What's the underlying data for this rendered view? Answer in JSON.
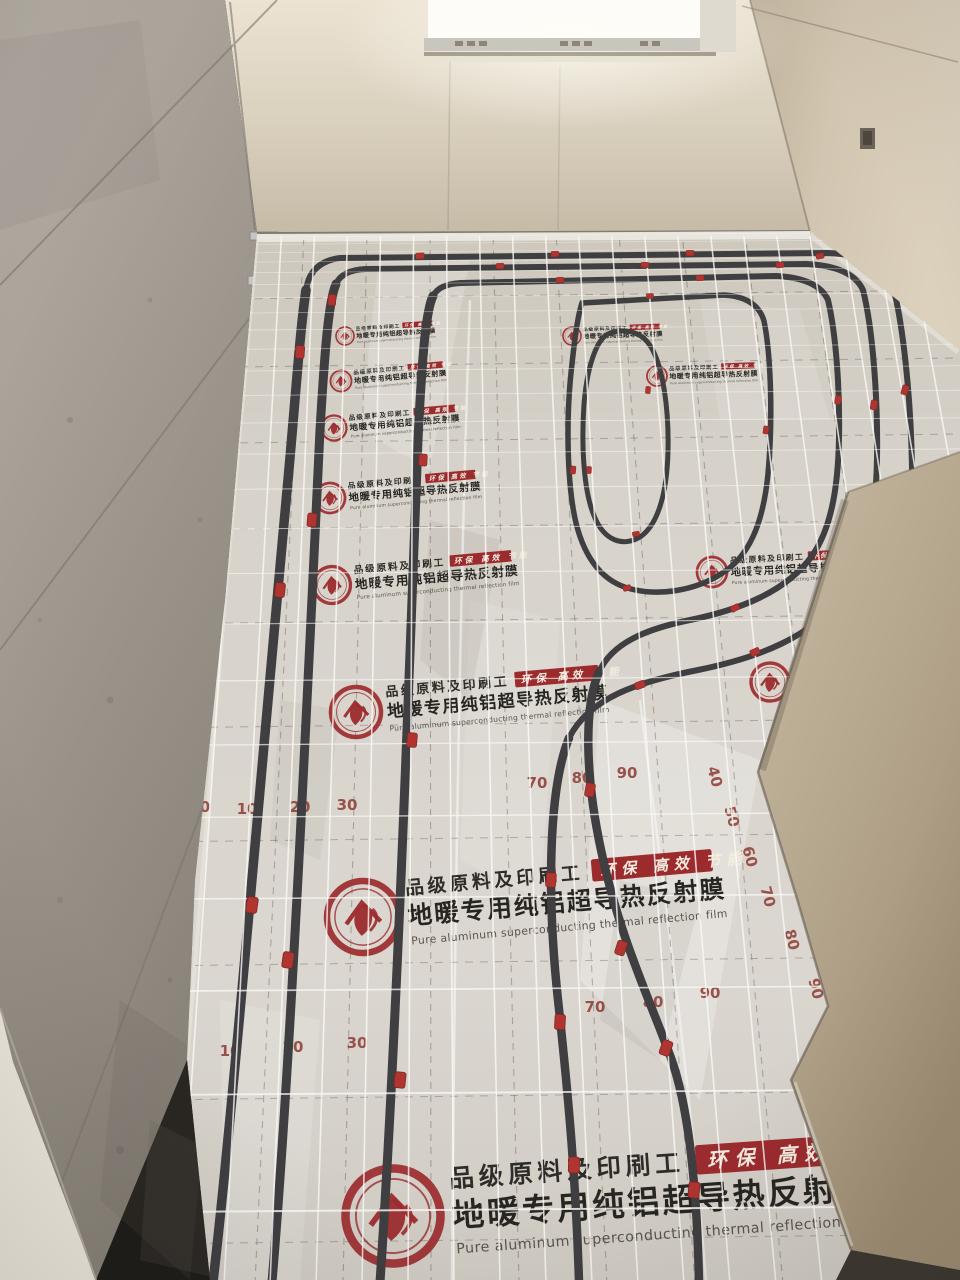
{
  "film": {
    "logo_icon": "house-leaf-emblem",
    "sub_label_cn": "品级原料及印刷工",
    "badge_cn": "环保 高效 节能",
    "title_cn": "地暖专用纯铝超导热反射膜",
    "title_en": "Pure aluminum superconducting thermal reflection film"
  },
  "colors": {
    "brand_red": "#9c2b2e",
    "clip_red": "#b03430",
    "ruler_red": "#8d3a33",
    "pipe_dark": "#3f3e40",
    "film_silver": "#d7d3cb",
    "mesh_white": "#faf9f6",
    "back_wall": "#d9cfbd",
    "right_wall": "#d2c6b1",
    "left_wall_concrete": "#9a948b",
    "pillar_tan": "#b5a68e",
    "window_glow": "#fcfcf9",
    "shadow_dark": "#3d3831"
  },
  "scene": {
    "ruler_marks": [
      {
        "v": "0",
        "x": 205,
        "y": 812,
        "rot": 0
      },
      {
        "v": "10",
        "x": 247,
        "y": 814,
        "rot": 0
      },
      {
        "v": "20",
        "x": 300,
        "y": 812,
        "rot": 0
      },
      {
        "v": "30",
        "x": 347,
        "y": 810,
        "rot": 0
      },
      {
        "v": "10",
        "x": 230,
        "y": 1056,
        "rot": 0
      },
      {
        "v": "20",
        "x": 293,
        "y": 1052,
        "rot": 0
      },
      {
        "v": "30",
        "x": 357,
        "y": 1048,
        "rot": 0
      },
      {
        "v": "70",
        "x": 537,
        "y": 788,
        "rot": 0
      },
      {
        "v": "80",
        "x": 582,
        "y": 783,
        "rot": 0
      },
      {
        "v": "90",
        "x": 627,
        "y": 778,
        "rot": 0
      },
      {
        "v": "40",
        "x": 710,
        "y": 778,
        "rot": 75
      },
      {
        "v": "50",
        "x": 727,
        "y": 818,
        "rot": 75
      },
      {
        "v": "60",
        "x": 745,
        "y": 858,
        "rot": 75
      },
      {
        "v": "70",
        "x": 763,
        "y": 898,
        "rot": 75
      },
      {
        "v": "80",
        "x": 787,
        "y": 941,
        "rot": 75
      },
      {
        "v": "90",
        "x": 811,
        "y": 990,
        "rot": 75
      },
      {
        "v": "70",
        "x": 595,
        "y": 1012,
        "rot": 0
      },
      {
        "v": "80",
        "x": 653,
        "y": 1007,
        "rot": 0
      },
      {
        "v": "90",
        "x": 710,
        "y": 998,
        "rot": 0
      }
    ],
    "label_bands": [
      {
        "x": 393,
        "y": 1216,
        "s": 0.95,
        "r": -4
      },
      {
        "x": 363,
        "y": 917,
        "s": 0.72,
        "r": -5
      },
      {
        "x": 356,
        "y": 712,
        "s": 0.5,
        "r": -5
      },
      {
        "x": 332,
        "y": 585,
        "s": 0.37,
        "r": -5
      },
      {
        "x": 330,
        "y": 498,
        "s": 0.3,
        "r": -5
      },
      {
        "x": 334,
        "y": 428,
        "s": 0.25,
        "r": -5
      },
      {
        "x": 341,
        "y": 381,
        "s": 0.21,
        "r": -5
      },
      {
        "x": 345,
        "y": 336,
        "s": 0.18,
        "r": -4
      },
      {
        "x": 572,
        "y": 336,
        "s": 0.18,
        "r": -2
      },
      {
        "x": 657,
        "y": 376,
        "s": 0.2,
        "r": -2
      },
      {
        "x": 712,
        "y": 572,
        "s": 0.3,
        "r": -3
      },
      {
        "x": 770,
        "y": 682,
        "s": 0.38,
        "r": -3
      }
    ],
    "clips": [
      {
        "x": 252,
        "y": 905,
        "r": 8,
        "s": 1.0
      },
      {
        "x": 280,
        "y": 590,
        "r": 6,
        "s": 0.9
      },
      {
        "x": 300,
        "y": 352,
        "r": 4,
        "s": 0.8
      },
      {
        "x": 420,
        "y": 256,
        "r": 88,
        "s": 0.55
      },
      {
        "x": 555,
        "y": 254,
        "r": 89,
        "s": 0.5
      },
      {
        "x": 690,
        "y": 253,
        "r": 90,
        "s": 0.5
      },
      {
        "x": 820,
        "y": 256,
        "r": 80,
        "s": 0.5
      },
      {
        "x": 905,
        "y": 390,
        "r": 15,
        "s": 0.6
      },
      {
        "x": 288,
        "y": 960,
        "r": 8,
        "s": 1.0
      },
      {
        "x": 312,
        "y": 520,
        "r": 5,
        "s": 0.85
      },
      {
        "x": 332,
        "y": 300,
        "r": 3,
        "s": 0.7
      },
      {
        "x": 500,
        "y": 266,
        "r": 88,
        "s": 0.5
      },
      {
        "x": 645,
        "y": 265,
        "r": 89,
        "s": 0.5
      },
      {
        "x": 780,
        "y": 265,
        "r": 85,
        "s": 0.5
      },
      {
        "x": 874,
        "y": 405,
        "r": 10,
        "s": 0.6
      },
      {
        "x": 755,
        "y": 652,
        "r": 65,
        "s": 0.6
      },
      {
        "x": 640,
        "y": 685,
        "r": 70,
        "s": 0.65
      },
      {
        "x": 551,
        "y": 880,
        "r": 5,
        "s": 0.9
      },
      {
        "x": 560,
        "y": 1022,
        "r": 3,
        "s": 0.95
      },
      {
        "x": 574,
        "y": 1165,
        "r": 2,
        "s": 1.0
      },
      {
        "x": 400,
        "y": 1080,
        "r": 6,
        "s": 1.0
      },
      {
        "x": 412,
        "y": 740,
        "r": 5,
        "s": 0.9
      },
      {
        "x": 423,
        "y": 460,
        "r": 3,
        "s": 0.75
      },
      {
        "x": 560,
        "y": 280,
        "r": 88,
        "s": 0.5
      },
      {
        "x": 700,
        "y": 278,
        "r": 87,
        "s": 0.5
      },
      {
        "x": 838,
        "y": 400,
        "r": 10,
        "s": 0.55
      },
      {
        "x": 735,
        "y": 608,
        "r": 60,
        "s": 0.55
      },
      {
        "x": 590,
        "y": 790,
        "r": 10,
        "s": 0.85
      },
      {
        "x": 621,
        "y": 948,
        "r": 18,
        "s": 0.9
      },
      {
        "x": 666,
        "y": 1048,
        "r": 20,
        "s": 0.95
      },
      {
        "x": 694,
        "y": 1190,
        "r": 5,
        "s": 1.0
      },
      {
        "x": 650,
        "y": 296,
        "r": 88,
        "s": 0.45
      },
      {
        "x": 766,
        "y": 430,
        "r": 8,
        "s": 0.5
      },
      {
        "x": 627,
        "y": 588,
        "r": 75,
        "s": 0.5
      },
      {
        "x": 573,
        "y": 470,
        "r": 5,
        "s": 0.5
      },
      {
        "x": 648,
        "y": 390,
        "r": 5,
        "s": 0.45
      },
      {
        "x": 589,
        "y": 470,
        "r": 3,
        "s": 0.45
      },
      {
        "x": 636,
        "y": 534,
        "r": 80,
        "s": 0.45
      }
    ]
  }
}
